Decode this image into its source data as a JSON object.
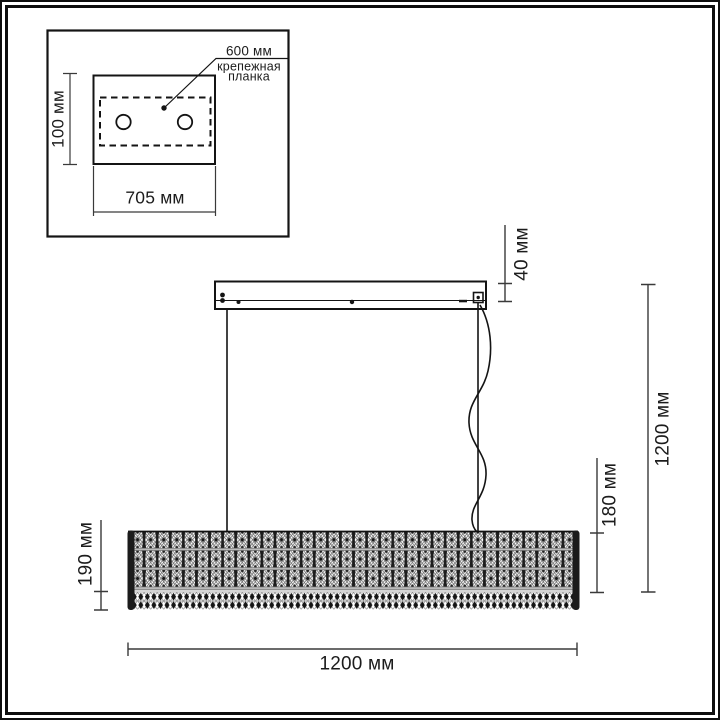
{
  "colors": {
    "ink": "#1c1c1c",
    "frame": "#0d0d0d",
    "line": "#141414",
    "dimline": "#3a3a3a",
    "crystal_dark": "#1d1d1d",
    "separator_gray": "#bdbdbd",
    "background": "#ffffff"
  },
  "inset": {
    "plate_width_label": "705 мм",
    "plate_depth_label": "100 мм",
    "bracket_length_label": "600 мм",
    "bracket_caption_line1": "крепежная",
    "bracket_caption_line2": "планка"
  },
  "dimensions": {
    "canopy_height": "40 мм",
    "overall_height": "1200 мм",
    "diffuser_height": "180 мм",
    "shade_height": "190 мм",
    "overall_length": "1200 мм"
  }
}
